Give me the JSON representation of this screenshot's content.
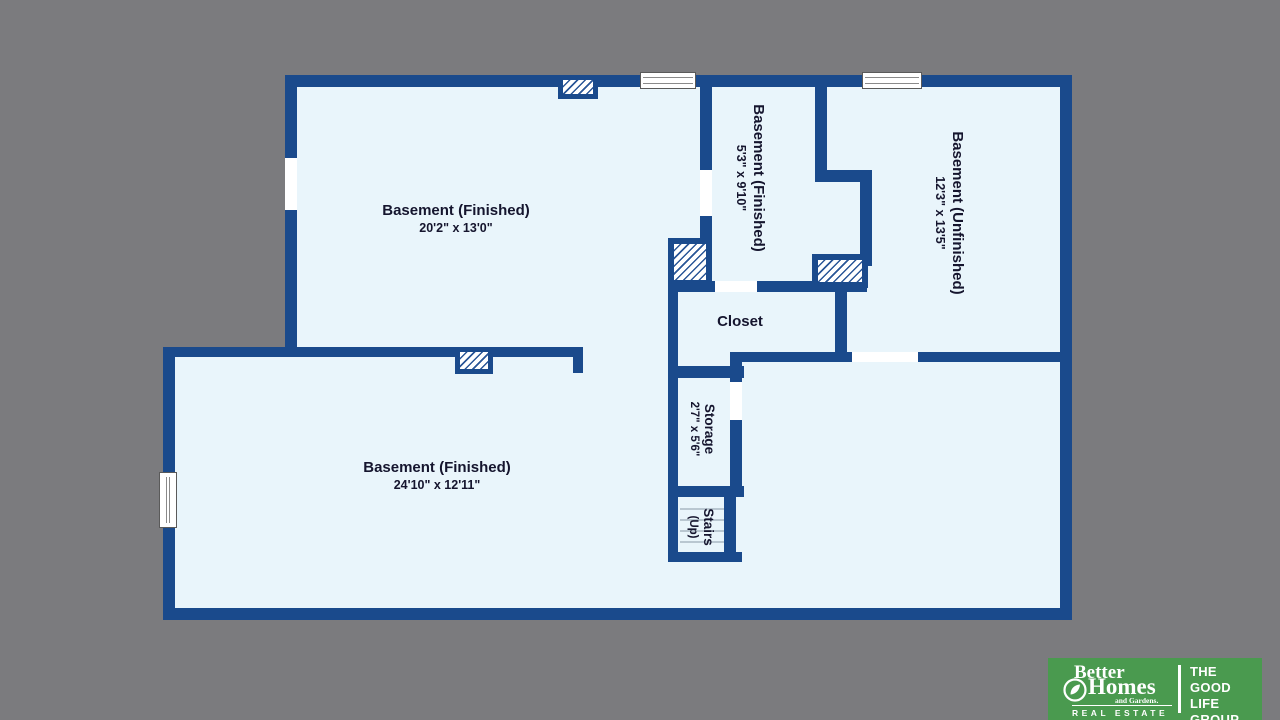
{
  "background_color": "#7b7b7e",
  "plan": {
    "wall_color": "#1a4a8c",
    "floor_color": "#e9f5fb",
    "rooms": [
      {
        "id": "basement-finished-top",
        "name": "Basement (Finished)",
        "dims": "20'2\" x 13'0\"",
        "orientation": "horizontal"
      },
      {
        "id": "basement-finished-mid",
        "name": "Basement (Finished)",
        "dims": "5'3\" x 9'10\"",
        "orientation": "vertical"
      },
      {
        "id": "basement-unfinished",
        "name": "Basement (Unfinished)",
        "dims": "12'3\" x 13'5\"",
        "orientation": "vertical"
      },
      {
        "id": "closet",
        "name": "Closet",
        "dims": "",
        "orientation": "horizontal"
      },
      {
        "id": "storage",
        "name": "Storage",
        "dims": "2'7\" x 5'6\"",
        "orientation": "vertical"
      },
      {
        "id": "stairs",
        "name": "Stairs",
        "dims": "(Up)",
        "orientation": "vertical"
      },
      {
        "id": "basement-finished-bottom",
        "name": "Basement (Finished)",
        "dims": "24'10\" x 12'11\"",
        "orientation": "horizontal"
      }
    ]
  },
  "logo": {
    "background_color": "#4a9a4f",
    "brand_line1": "Better",
    "brand_line2": "Homes",
    "brand_line3": "and Gardens.",
    "brand_line4": "REAL ESTATE",
    "group_line1": "THE",
    "group_line2": "GOOD LIFE",
    "group_line3": "GROUP"
  }
}
